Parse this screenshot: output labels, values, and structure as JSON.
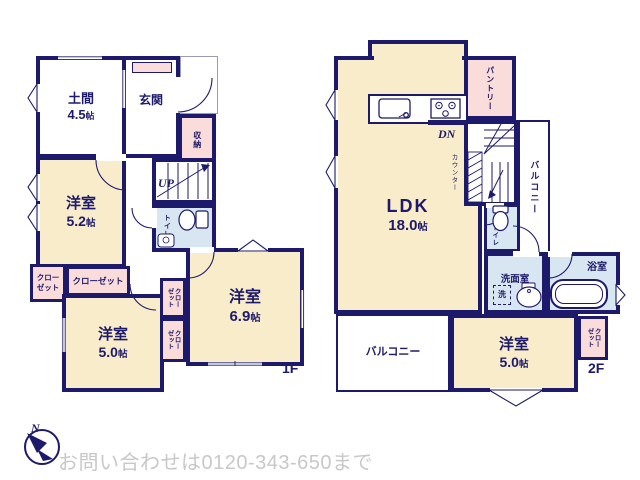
{
  "meta": {
    "document_type": "floor-plan"
  },
  "colors": {
    "wall": "#1d1a6b",
    "room_beige": "#f8ecca",
    "closet_pink": "#fadcdb",
    "wet_area_blue": "#d7e6f0",
    "outline_thin": "#9b9bb5",
    "footer_text_gray": "#c8c8c8"
  },
  "footer": {
    "contact": "お問い合わせは0120-343-650まで",
    "compass_n": "N"
  },
  "floor1": {
    "floor_label": "1F",
    "doma": {
      "name": "土間",
      "size": "4.5",
      "unit": "帖"
    },
    "genkan": {
      "name": "玄関"
    },
    "shuno": {
      "name": "収納"
    },
    "stairs_label": "UP",
    "toilet": {
      "name": "トイレ"
    },
    "room52": {
      "name": "洋室",
      "size": "5.2",
      "unit": "帖"
    },
    "closet_small": {
      "line1": "クロー",
      "line2": "ゼット"
    },
    "closet_top": {
      "name": "クローゼット"
    },
    "closet_mid1": {
      "line1": "クロー",
      "line2": "ゼット"
    },
    "closet_mid2": {
      "line1": "クロー",
      "line2": "ゼット"
    },
    "room50": {
      "name": "洋室",
      "size": "5.0",
      "unit": "帖"
    },
    "room69": {
      "name": "洋室",
      "size": "6.9",
      "unit": "帖"
    }
  },
  "floor2": {
    "floor_label": "2F",
    "ldk": {
      "name": "LDK",
      "size": "18.0",
      "unit": "帖"
    },
    "pantry": {
      "name": "パントリー"
    },
    "stairs_label": "DN",
    "counter": {
      "name": "カウンター"
    },
    "balcony_side": {
      "name": "バルコニー"
    },
    "toilet": {
      "name": "トイレ"
    },
    "senmen": {
      "name": "洗面室",
      "washer": "洗"
    },
    "bath": {
      "name": "浴室"
    },
    "balcony_bottom": {
      "name": "バルコニー"
    },
    "room50": {
      "name": "洋室",
      "size": "5.0",
      "unit": "帖"
    },
    "closet": {
      "line1": "クロー",
      "line2": "ゼット"
    }
  },
  "icons": {
    "compass": "north-arrow-bird",
    "toilet": "toilet-bowl",
    "bath": "bathtub",
    "kitchen_sink": "kitchen-sink",
    "stove": "three-burner-stove",
    "washbasin": "oval-washbasin",
    "stairs_up": "staircase-up",
    "stairs_down": "staircase-down",
    "door": "swing-door-arc",
    "window": "casement-chevron"
  }
}
